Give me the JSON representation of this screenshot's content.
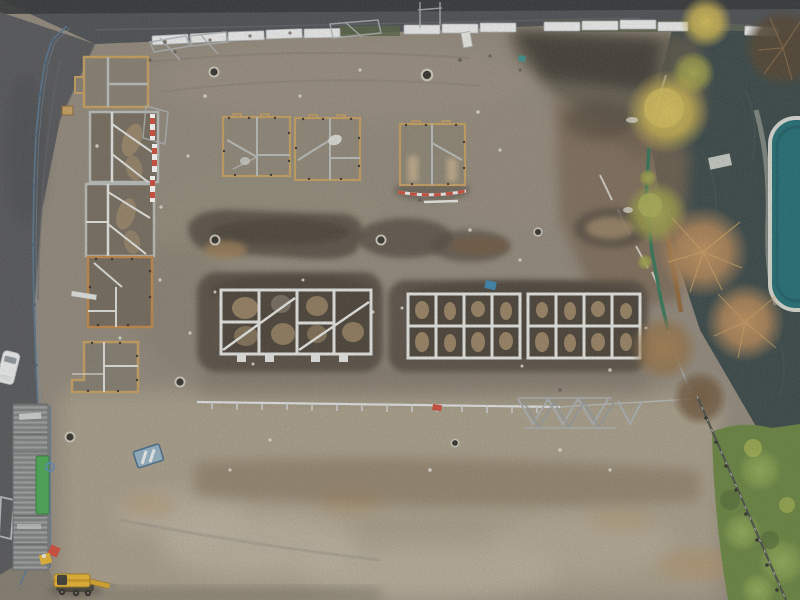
{
  "scene": {
    "description": "Aerial drone photograph of a housing construction site: timber-edged foundation plots on the left and top, two long white strip-foundation grids in the centre, excavated dark trenches, perimeter fencing and white hoarding along a road at the top, a dark road down the left edge with a parked white van, autumn trees and a pond with a turquoise pool along the right edge, a green hedge at bottom right, stacked trench shoring and a yellow excavator at bottom left.",
    "objects": [
      "top road",
      "left road",
      "white hoarding panels",
      "blue perimeter fence",
      "timber foundation frames",
      "strip foundation grids",
      "excavated trenches",
      "manhole covers",
      "red-and-white barrier rails",
      "scaffold tube line",
      "steel trestles",
      "shoring material stack",
      "green machine strip",
      "blue site sign",
      "yellow excavator",
      "white van",
      "parking bay marking",
      "pond water",
      "turquoise pool with white rim",
      "autumn trees",
      "green hedge"
    ]
  },
  "palette": {
    "dirt_base": "#8c8376",
    "dirt_light": "#aba089",
    "dirt_pale": "#c3b9a7",
    "road_top": "#41464b",
    "road_edge": "#26292d",
    "road_left": "#4b4d52",
    "water": "#2c3c3e",
    "pool": "#13666e",
    "pool_rim": "#d6d9d3",
    "excavation": "#4b4339",
    "excavation_deep": "#362f28",
    "soil_tan": "#a88e67",
    "soil_brown": "#705c46",
    "gravel_brown": "#7d6b52",
    "timber": "#c59b58",
    "timber_orange": "#bf8140",
    "strip_white": "#e6e8e6",
    "strip_grey": "#b7bcba",
    "fence_white": "#eef0f1",
    "fence_blue": "#4e708f",
    "fence_green": "#1e6e4f",
    "mesh_grey": "#aab2b6",
    "barrier_red": "#cf4130",
    "machine_yellow": "#e9b226",
    "machine_green": "#3da44a",
    "sign_blue": "#8fb0c4",
    "van_white": "#eef0f2",
    "hedge": "#5f7e36",
    "tree_yellow": "#c9b148",
    "tree_olive": "#98993f",
    "tree_orange": "#b58350",
    "bush_dark": "#483a28",
    "frost": "#e9e8e1",
    "manhole_dark": "#262622",
    "manhole_rim": "#cec9bb"
  }
}
